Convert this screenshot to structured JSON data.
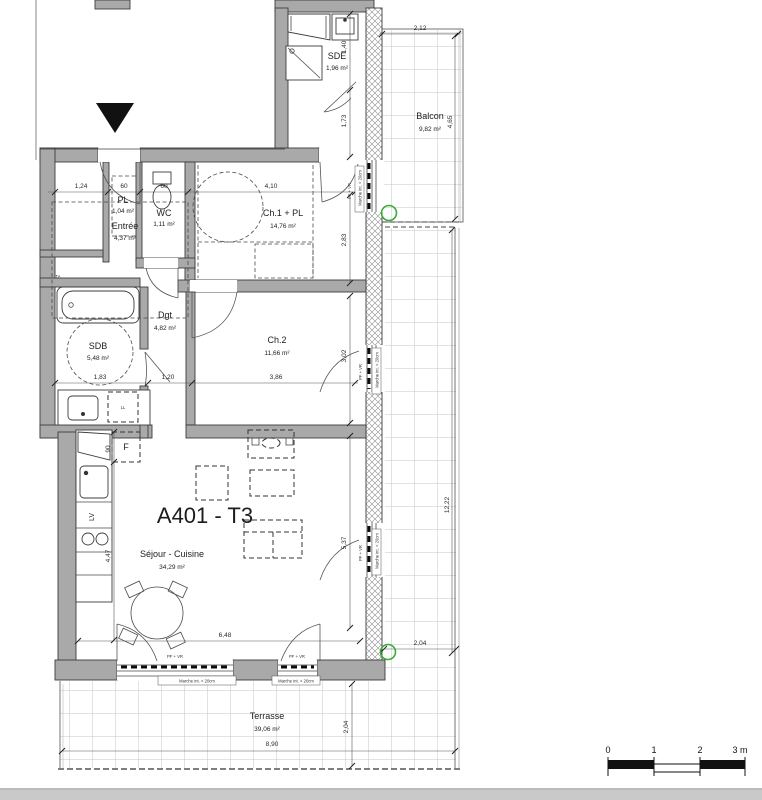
{
  "plan": {
    "title": "A401 - T3",
    "rooms": [
      {
        "name": "Entrée",
        "area": "4,37 m²"
      },
      {
        "name": "PL",
        "area": "1,04 m²"
      },
      {
        "name": "WC",
        "area": "1,11 m²"
      },
      {
        "name": "Ch.1 + PL",
        "area": "14,76 m²"
      },
      {
        "name": "SDE",
        "area": "1,96 m²"
      },
      {
        "name": "Balcon",
        "area": "9,82 m²"
      },
      {
        "name": "Dgt",
        "area": "4,82 m²"
      },
      {
        "name": "Ch.2",
        "area": "11,66 m²"
      },
      {
        "name": "SDB",
        "area": "5,48 m²"
      },
      {
        "name": "Séjour - Cuisine",
        "area": "34,29 m²"
      },
      {
        "name": "Terrasse",
        "area": "39,06 m²"
      }
    ],
    "fixtures": {
      "fridge": "F",
      "dishwasher": "LV",
      "washing_machine": "LL",
      "electrical_panel": "TA"
    },
    "window_labels": {
      "pf_vr": "PF + VR",
      "step": "Marche int. < 20cm"
    },
    "dimensions": [
      "1,24",
      "60",
      "60",
      "4,10",
      "2,83",
      "1,40",
      "1,73",
      "2,12",
      "4,65",
      "1,83",
      "1,20",
      "3,86",
      "3,02",
      "90",
      "4,47",
      "6,48",
      "5,37",
      "12,22",
      "2,04",
      "2,04",
      "8,90"
    ],
    "scale_bar": {
      "labels": [
        "0",
        "1",
        "2",
        "3 m"
      ]
    },
    "colors": {
      "wall": "#a9a9a9",
      "marker_green": "#3aaa35"
    }
  }
}
